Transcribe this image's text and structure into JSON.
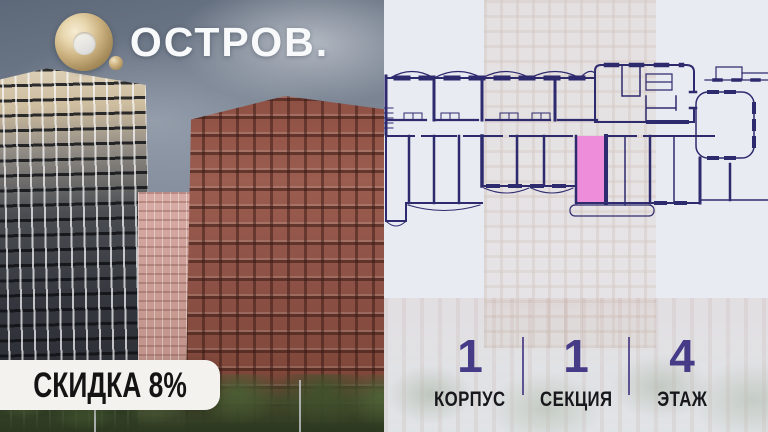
{
  "brand": {
    "logo_text": "ОСТРОВ."
  },
  "promo": {
    "discount_label": "СКИДКА 8%"
  },
  "unit_info": {
    "stats": [
      {
        "value": "1",
        "label": "КОРПУС"
      },
      {
        "value": "1",
        "label": "СЕКЦИЯ"
      },
      {
        "value": "4",
        "label": "ЭТАЖ"
      }
    ]
  },
  "colors": {
    "plan_line": "#2e2a6e",
    "unit_highlight": "#ee8edb",
    "unit_highlight_border": "#2e2a6e",
    "stat_number": "#463b86",
    "brand_gold": "#c9ad7a",
    "badge_bg": "#f4f2ee",
    "badge_text": "#141414"
  }
}
